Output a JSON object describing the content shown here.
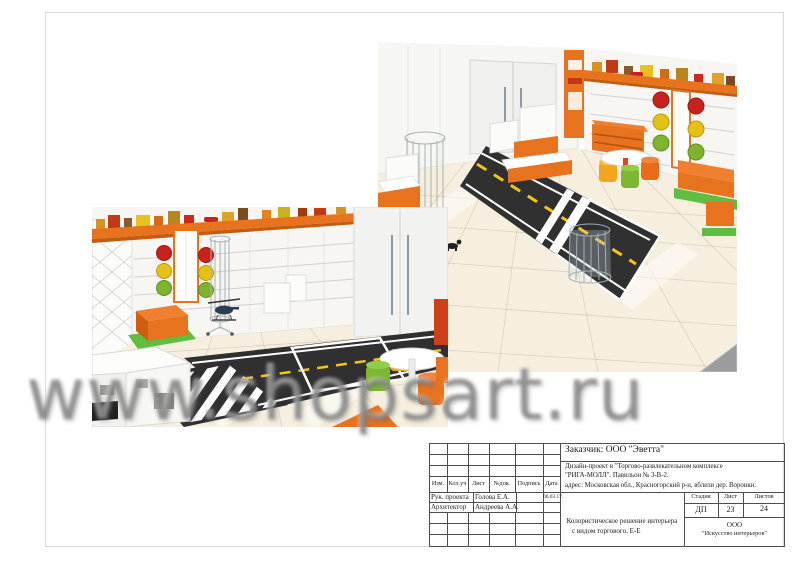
{
  "watermark": {
    "text": "www.shopsart.ru"
  },
  "title_block": {
    "customer": "Заказчик:  ООО \"Эветта\"",
    "project_line1": "Дизайн-проект в  \"Торгово-развлекательном комплексе",
    "project_line2": "\"РИГА-МОЛЛ\". Павильон № 3-В-2.",
    "project_line3": "адрес: Московская обл., Красногорский р-н, вблизи дер. Воронки.",
    "col_headers": [
      "Изм.",
      "Кол.уч",
      "Лист",
      "№док.",
      "Подпись",
      "Дата"
    ],
    "sign_rows": [
      {
        "role": "Рук. проекта",
        "name": "Голова Е.А.",
        "date": "06.03.17."
      },
      {
        "role": "Архитектор",
        "name": "Андреева А.А.",
        "date": ""
      }
    ],
    "stage_label": "Стадия",
    "sheet_label": "Лист",
    "sheets_label": "Листов",
    "stage": "ДП",
    "sheet_no": "23",
    "sheets_total": "24",
    "doc_line1": "Колористическое решение интерьера",
    "doc_line2": "с видом торгового. Е-Е",
    "company_line1": "ООО",
    "company_line2": "\"Искусство интерьеров\""
  },
  "renders": {
    "left": {
      "name": "store-interior-render-shelving-view"
    },
    "right": {
      "name": "store-interior-render-entrance-view"
    }
  },
  "colors": {
    "accent_orange": "#E8731F",
    "road_asphalt": "#303030",
    "road_marking_yellow": "#F2C41D",
    "floor_beige": "#F6EFDF",
    "mat_green": "#5FBE3F",
    "traffic_red": "#C9221C",
    "traffic_yellow": "#E5C118",
    "traffic_green": "#7FB32D"
  }
}
